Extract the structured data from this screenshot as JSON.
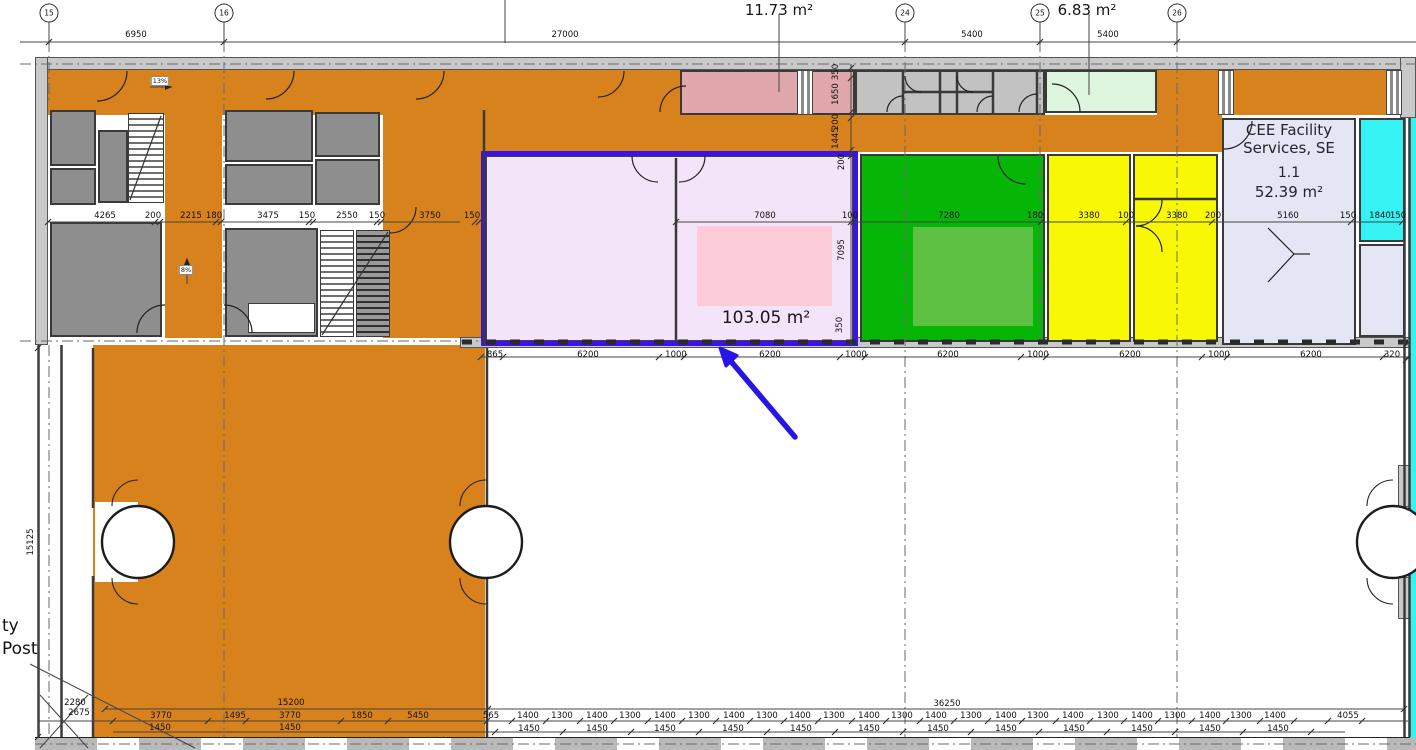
{
  "colors": {
    "corridor_orange": "#d8821d",
    "room_gray": "#8e8e8e",
    "wall_gray": "#c9c9c9",
    "pink_room": "#dfa7ac",
    "mint_room": "#def5de",
    "selected_fill": "#f4e4f9",
    "selected_inner_pink": "#fbccd8",
    "selection_purple": "#3a13e6",
    "green_room": "#06b606",
    "green_inner": "#5ec143",
    "yellow_room": "#f8f805",
    "cee_lavender": "#e5e6f5",
    "cyan_room": "#35f3f3",
    "arrow_blue": "#2715e8"
  },
  "rooms": {
    "storage_top": {
      "area_label": "11.73 m²"
    },
    "mint_top": {
      "area_label": "6.83 m²"
    },
    "selected": {
      "area_label": "103.05 m²"
    },
    "cee": {
      "line1": "CEE Facility",
      "line2": "Services, SE",
      "number": "1.1",
      "area_label": "52.39 m²"
    }
  },
  "annotations": {
    "ramp_right": "13%",
    "ramp_up": "8%",
    "post_line1": "ty",
    "post_line2": "Post"
  },
  "grid_bubbles": [
    {
      "x": 49,
      "y": 13,
      "label": "15"
    },
    {
      "x": 224,
      "y": 13,
      "label": "16"
    },
    {
      "x": 905,
      "y": 13,
      "label": "24"
    },
    {
      "x": 1040,
      "y": 13,
      "label": "25"
    },
    {
      "x": 1177,
      "y": 13,
      "label": "26"
    }
  ],
  "dimensions": {
    "top": [
      {
        "x": 136,
        "y": 35,
        "label": "6950"
      },
      {
        "x": 565,
        "y": 35,
        "label": "27000"
      },
      {
        "x": 972,
        "y": 35,
        "label": "5400"
      },
      {
        "x": 1108,
        "y": 35,
        "label": "5400"
      }
    ],
    "left_row": [
      {
        "x": 105,
        "y": 216,
        "label": "4265"
      },
      {
        "x": 153,
        "y": 216,
        "label": "200"
      },
      {
        "x": 191,
        "y": 216,
        "label": "2215"
      },
      {
        "x": 214,
        "y": 216,
        "label": "180"
      },
      {
        "x": 268,
        "y": 216,
        "label": "3475"
      },
      {
        "x": 307,
        "y": 216,
        "label": "150"
      },
      {
        "x": 347,
        "y": 216,
        "label": "2550"
      },
      {
        "x": 377,
        "y": 216,
        "label": "150"
      },
      {
        "x": 430,
        "y": 216,
        "label": "3750"
      },
      {
        "x": 472,
        "y": 216,
        "label": "150"
      }
    ],
    "inner_row": [
      {
        "x": 765,
        "y": 216,
        "label": "7080"
      },
      {
        "x": 850,
        "y": 216,
        "label": "100"
      },
      {
        "x": 949,
        "y": 216,
        "label": "7280"
      },
      {
        "x": 1035,
        "y": 216,
        "label": "180"
      },
      {
        "x": 1089,
        "y": 216,
        "label": "3380"
      },
      {
        "x": 1126,
        "y": 216,
        "label": "100"
      },
      {
        "x": 1177,
        "y": 216,
        "label": "3380"
      },
      {
        "x": 1213,
        "y": 216,
        "label": "200"
      },
      {
        "x": 1288,
        "y": 216,
        "label": "5160"
      },
      {
        "x": 1348,
        "y": 216,
        "label": "150"
      },
      {
        "x": 1380,
        "y": 216,
        "label": "1840"
      },
      {
        "x": 1398,
        "y": 216,
        "label": "150"
      }
    ],
    "vertical": [
      {
        "x": 836,
        "y": 72,
        "label": "350",
        "rotate": -90
      },
      {
        "x": 836,
        "y": 94,
        "label": "1650",
        "rotate": -90
      },
      {
        "x": 836,
        "y": 122,
        "label": "200",
        "rotate": -90
      },
      {
        "x": 836,
        "y": 138,
        "label": "1445",
        "rotate": -90
      },
      {
        "x": 842,
        "y": 162,
        "label": "200",
        "rotate": -90
      },
      {
        "x": 842,
        "y": 250,
        "label": "7095",
        "rotate": -90
      },
      {
        "x": 840,
        "y": 325,
        "label": "350",
        "rotate": -90
      },
      {
        "x": 31,
        "y": 542,
        "label": "15125",
        "rotate": -90
      }
    ],
    "below_band": [
      {
        "x": 495,
        "y": 355,
        "label": "865"
      },
      {
        "x": 588,
        "y": 355,
        "label": "6200"
      },
      {
        "x": 676,
        "y": 355,
        "label": "1000"
      },
      {
        "x": 770,
        "y": 355,
        "label": "6200"
      },
      {
        "x": 856,
        "y": 355,
        "label": "1000"
      },
      {
        "x": 948,
        "y": 355,
        "label": "6200"
      },
      {
        "x": 1038,
        "y": 355,
        "label": "1000"
      },
      {
        "x": 1130,
        "y": 355,
        "label": "6200"
      },
      {
        "x": 1219,
        "y": 355,
        "label": "1000"
      },
      {
        "x": 1311,
        "y": 355,
        "label": "6200"
      },
      {
        "x": 1392,
        "y": 355,
        "label": "320"
      }
    ],
    "bottom_left": [
      {
        "x": 75,
        "y": 703,
        "label": "2280"
      },
      {
        "x": 79,
        "y": 713,
        "label": "2675"
      },
      {
        "x": 291,
        "y": 703,
        "label": "15200"
      },
      {
        "x": 161,
        "y": 716,
        "label": "3770"
      },
      {
        "x": 235,
        "y": 716,
        "label": "1495"
      },
      {
        "x": 290,
        "y": 716,
        "label": "3770"
      },
      {
        "x": 362,
        "y": 716,
        "label": "1850"
      },
      {
        "x": 418,
        "y": 716,
        "label": "5450"
      },
      {
        "x": 160,
        "y": 728,
        "label": "1450"
      },
      {
        "x": 290,
        "y": 728,
        "label": "1450"
      }
    ],
    "bottom_total": [
      {
        "x": 947,
        "y": 704,
        "label": "36250"
      }
    ],
    "bottom_main": [
      {
        "x": 491,
        "y": 716,
        "label": "565"
      },
      {
        "x": 528,
        "y": 716,
        "label": "1400"
      },
      {
        "x": 562,
        "y": 716,
        "label": "1300"
      },
      {
        "x": 597,
        "y": 716,
        "label": "1400"
      },
      {
        "x": 630,
        "y": 716,
        "label": "1300"
      },
      {
        "x": 665,
        "y": 716,
        "label": "1400"
      },
      {
        "x": 699,
        "y": 716,
        "label": "1300"
      },
      {
        "x": 734,
        "y": 716,
        "label": "1400"
      },
      {
        "x": 767,
        "y": 716,
        "label": "1300"
      },
      {
        "x": 800,
        "y": 716,
        "label": "1400"
      },
      {
        "x": 834,
        "y": 716,
        "label": "1300"
      },
      {
        "x": 869,
        "y": 716,
        "label": "1400"
      },
      {
        "x": 902,
        "y": 716,
        "label": "1300"
      },
      {
        "x": 936,
        "y": 716,
        "label": "1400"
      },
      {
        "x": 971,
        "y": 716,
        "label": "1300"
      },
      {
        "x": 1006,
        "y": 716,
        "label": "1400"
      },
      {
        "x": 1038,
        "y": 716,
        "label": "1300"
      },
      {
        "x": 1073,
        "y": 716,
        "label": "1400"
      },
      {
        "x": 1108,
        "y": 716,
        "label": "1300"
      },
      {
        "x": 1142,
        "y": 716,
        "label": "1400"
      },
      {
        "x": 1175,
        "y": 716,
        "label": "1300"
      },
      {
        "x": 1210,
        "y": 716,
        "label": "1400"
      },
      {
        "x": 1241,
        "y": 716,
        "label": "1300"
      },
      {
        "x": 1275,
        "y": 716,
        "label": "1400"
      },
      {
        "x": 1348,
        "y": 716,
        "label": "4055"
      }
    ],
    "bottom_1450": [
      {
        "x": 529,
        "y": 729,
        "label": "1450"
      },
      {
        "x": 597,
        "y": 729,
        "label": "1450"
      },
      {
        "x": 665,
        "y": 729,
        "label": "1450"
      },
      {
        "x": 733,
        "y": 729,
        "label": "1450"
      },
      {
        "x": 801,
        "y": 729,
        "label": "1450"
      },
      {
        "x": 869,
        "y": 729,
        "label": "1450"
      },
      {
        "x": 938,
        "y": 729,
        "label": "1450"
      },
      {
        "x": 1006,
        "y": 729,
        "label": "1450"
      },
      {
        "x": 1074,
        "y": 729,
        "label": "1450"
      },
      {
        "x": 1142,
        "y": 729,
        "label": "1450"
      },
      {
        "x": 1210,
        "y": 729,
        "label": "1450"
      },
      {
        "x": 1278,
        "y": 729,
        "label": "1450"
      }
    ]
  }
}
